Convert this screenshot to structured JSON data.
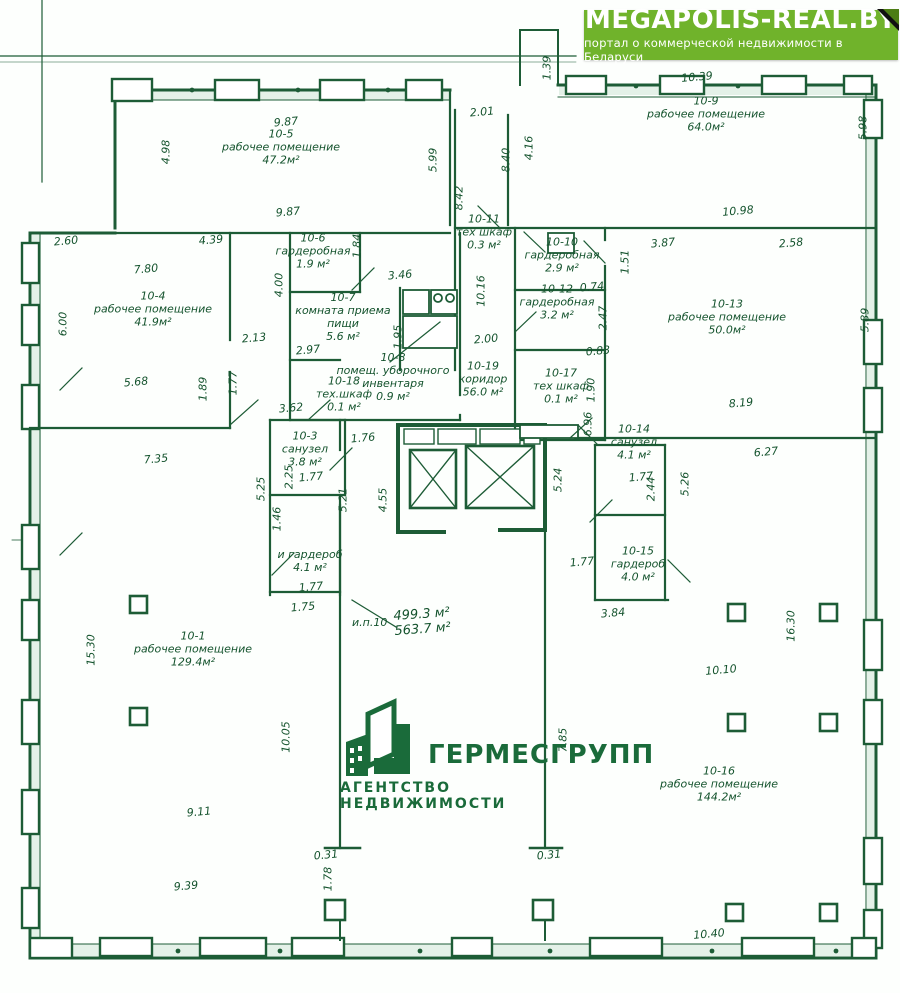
{
  "banner": {
    "title": "MEGAPOLIS-REAL.BY",
    "subtitle": "портал о коммерческой недвижимости в Беларуси",
    "bg_color": "#70b32b"
  },
  "watermark": {
    "name": "ГЕРМЕСГРУПП",
    "tagline": "АГЕНТСТВО НЕДВИЖИМОСТИ",
    "color": "#1a6b3a"
  },
  "plan": {
    "line_color": "#1d5c36",
    "total": {
      "label": "и.п.10",
      "area1": "499.3 м²",
      "area2": "563.7 м²"
    },
    "rooms": [
      {
        "id": "10-5",
        "name": "рабочее помещение",
        "area": "47.2м²",
        "x": 281,
        "y": 148
      },
      {
        "id": "10-9",
        "name": "рабочее помещение",
        "area": "64.0м²",
        "x": 706,
        "y": 115
      },
      {
        "id": "10-6",
        "name": "гардеробная",
        "area": "1.9 м²",
        "x": 313,
        "y": 252
      },
      {
        "id": "10-11",
        "name": "тех шкаф",
        "area": "0.3 м²",
        "x": 484,
        "y": 233
      },
      {
        "id": "10-10",
        "name": "гардеробная",
        "area": "2.9 м²",
        "x": 562,
        "y": 256
      },
      {
        "id": "10-4",
        "name": "рабочее помещение",
        "area": "41.9м²",
        "x": 153,
        "y": 310
      },
      {
        "id": "10-7",
        "name": "комната приема пищи",
        "area": "5.6 м²",
        "x": 343,
        "y": 318
      },
      {
        "id": "10-12",
        "name": "гардеробная",
        "area": "3.2 м²",
        "x": 557,
        "y": 303
      },
      {
        "id": "10-13",
        "name": "рабочее помещение",
        "area": "50.0м²",
        "x": 727,
        "y": 318
      },
      {
        "id": "10-19",
        "name": "коридор",
        "area": "56.0 м²",
        "x": 483,
        "y": 380
      },
      {
        "id": "10-8",
        "name": "помещ. уборочного инвентаря",
        "area": "0.9 м²",
        "x": 393,
        "y": 378
      },
      {
        "id": "10-18",
        "name": "тех.шкаф",
        "area": "0.1 м²",
        "x": 344,
        "y": 395
      },
      {
        "id": "10-17",
        "name": "тех шкаф",
        "area": "0.1 м²",
        "x": 561,
        "y": 387
      },
      {
        "id": "10-3",
        "name": "санузел",
        "area": "3.8 м²",
        "x": 305,
        "y": 450
      },
      {
        "id": "10-14",
        "name": "санузел",
        "area": "4.1 м²",
        "x": 634,
        "y": 443
      },
      {
        "id": "10-15",
        "name": "гардероб",
        "area": "4.0 м²",
        "x": 638,
        "y": 565
      },
      {
        "id": "",
        "name": "и гардероб",
        "area": "4.1 м²",
        "x": 310,
        "y": 562
      },
      {
        "id": "10-1",
        "name": "рабочее помещение",
        "area": "129.4м²",
        "x": 193,
        "y": 650
      },
      {
        "id": "10-16",
        "name": "рабочее помещение",
        "area": "144.2м²",
        "x": 719,
        "y": 785
      }
    ],
    "dims": [
      {
        "v": "1.39",
        "x": 547,
        "y": 68,
        "o": "v"
      },
      {
        "v": "10.39",
        "x": 697,
        "y": 77,
        "o": "h"
      },
      {
        "v": "5.98",
        "x": 863,
        "y": 128,
        "o": "v"
      },
      {
        "v": "9.87",
        "x": 286,
        "y": 122,
        "o": "h"
      },
      {
        "v": "4.98",
        "x": 166,
        "y": 152,
        "o": "v"
      },
      {
        "v": "2.01",
        "x": 482,
        "y": 112,
        "o": "h"
      },
      {
        "v": "5.99",
        "x": 433,
        "y": 160,
        "o": "v"
      },
      {
        "v": "8.40",
        "x": 506,
        "y": 160,
        "o": "v"
      },
      {
        "v": "4.16",
        "x": 529,
        "y": 148,
        "o": "v"
      },
      {
        "v": "8.42",
        "x": 459,
        "y": 198,
        "o": "v"
      },
      {
        "v": "9.87",
        "x": 288,
        "y": 212,
        "o": "h"
      },
      {
        "v": "10.98",
        "x": 738,
        "y": 211,
        "o": "h"
      },
      {
        "v": "2.60",
        "x": 66,
        "y": 241,
        "o": "h"
      },
      {
        "v": "4.39",
        "x": 211,
        "y": 240,
        "o": "h"
      },
      {
        "v": "1.84",
        "x": 357,
        "y": 246,
        "o": "v"
      },
      {
        "v": "3.87",
        "x": 663,
        "y": 243,
        "o": "h"
      },
      {
        "v": "2.58",
        "x": 791,
        "y": 243,
        "o": "h"
      },
      {
        "v": "1.51",
        "x": 625,
        "y": 262,
        "o": "v"
      },
      {
        "v": "7.80",
        "x": 146,
        "y": 269,
        "o": "h"
      },
      {
        "v": "4.00",
        "x": 279,
        "y": 285,
        "o": "v"
      },
      {
        "v": "3.46",
        "x": 400,
        "y": 275,
        "o": "h"
      },
      {
        "v": "0.74",
        "x": 592,
        "y": 287,
        "o": "h"
      },
      {
        "v": "10.16",
        "x": 481,
        "y": 291,
        "o": "v"
      },
      {
        "v": "6.00",
        "x": 63,
        "y": 324,
        "o": "v"
      },
      {
        "v": "2.47",
        "x": 603,
        "y": 318,
        "o": "v"
      },
      {
        "v": "5.89",
        "x": 865,
        "y": 320,
        "o": "v"
      },
      {
        "v": "2.13",
        "x": 254,
        "y": 338,
        "o": "h"
      },
      {
        "v": "2.97",
        "x": 308,
        "y": 350,
        "o": "h"
      },
      {
        "v": "1.95",
        "x": 398,
        "y": 337,
        "o": "v"
      },
      {
        "v": "2.00",
        "x": 486,
        "y": 339,
        "o": "h"
      },
      {
        "v": "0.83",
        "x": 598,
        "y": 351,
        "o": "h"
      },
      {
        "v": "5.68",
        "x": 136,
        "y": 382,
        "o": "h"
      },
      {
        "v": "1.89",
        "x": 203,
        "y": 389,
        "o": "v"
      },
      {
        "v": "1.77",
        "x": 233,
        "y": 383,
        "o": "v"
      },
      {
        "v": "1.90",
        "x": 591,
        "y": 390,
        "o": "v"
      },
      {
        "v": "8.19",
        "x": 741,
        "y": 403,
        "o": "h"
      },
      {
        "v": "3.62",
        "x": 291,
        "y": 408,
        "o": "h"
      },
      {
        "v": "6.96",
        "x": 588,
        "y": 424,
        "o": "v"
      },
      {
        "v": "1.76",
        "x": 363,
        "y": 438,
        "o": "h"
      },
      {
        "v": "6.27",
        "x": 766,
        "y": 452,
        "o": "h"
      },
      {
        "v": "7.35",
        "x": 156,
        "y": 459,
        "o": "h"
      },
      {
        "v": "2.25",
        "x": 289,
        "y": 477,
        "o": "v"
      },
      {
        "v": "1.77",
        "x": 311,
        "y": 477,
        "o": "h"
      },
      {
        "v": "5.25",
        "x": 261,
        "y": 489,
        "o": "v"
      },
      {
        "v": "5.21",
        "x": 343,
        "y": 500,
        "o": "v"
      },
      {
        "v": "4.55",
        "x": 383,
        "y": 500,
        "o": "v"
      },
      {
        "v": "5.24",
        "x": 558,
        "y": 480,
        "o": "v"
      },
      {
        "v": "1.77",
        "x": 641,
        "y": 477,
        "o": "h"
      },
      {
        "v": "2.44",
        "x": 651,
        "y": 489,
        "o": "v"
      },
      {
        "v": "5.26",
        "x": 685,
        "y": 484,
        "o": "v"
      },
      {
        "v": "1.46",
        "x": 277,
        "y": 519,
        "o": "v"
      },
      {
        "v": "1.77",
        "x": 582,
        "y": 562,
        "o": "h"
      },
      {
        "v": "1.77",
        "x": 311,
        "y": 587,
        "o": "h"
      },
      {
        "v": "3.84",
        "x": 613,
        "y": 613,
        "o": "h"
      },
      {
        "v": "1.75",
        "x": 303,
        "y": 607,
        "o": "h"
      },
      {
        "v": "15.30",
        "x": 91,
        "y": 650,
        "o": "v"
      },
      {
        "v": "16.30",
        "x": 791,
        "y": 626,
        "o": "v"
      },
      {
        "v": "10.10",
        "x": 721,
        "y": 670,
        "o": "h"
      },
      {
        "v": "10.05",
        "x": 286,
        "y": 737,
        "o": "v"
      },
      {
        "v": "7.85",
        "x": 563,
        "y": 740,
        "o": "v"
      },
      {
        "v": "9.11",
        "x": 199,
        "y": 812,
        "o": "h"
      },
      {
        "v": "0.31",
        "x": 326,
        "y": 855,
        "o": "h"
      },
      {
        "v": "0.31",
        "x": 549,
        "y": 855,
        "o": "h"
      },
      {
        "v": "1.78",
        "x": 328,
        "y": 879,
        "o": "v"
      },
      {
        "v": "9.39",
        "x": 186,
        "y": 886,
        "o": "h"
      },
      {
        "v": "10.40",
        "x": 709,
        "y": 934,
        "o": "h"
      }
    ]
  }
}
